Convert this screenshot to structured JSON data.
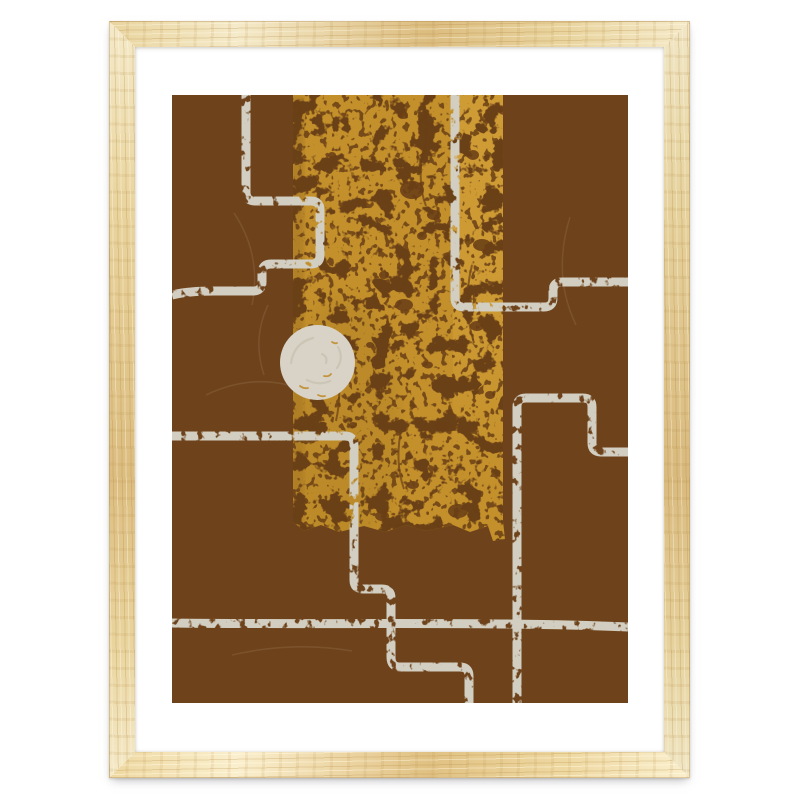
{
  "title": "Framed abstract art print",
  "colors": {
    "page_background": "#ffffff",
    "frame_wood_base": "#e9d49e",
    "frame_wood_light": "#f5eac9",
    "frame_wood_dark": "#dcbd80",
    "mat": "#ffffff",
    "art_brown": "#6e421a",
    "band_mustard": "#c3902b",
    "band_mustard_light": "#cf9c35",
    "speckle_brown": "#6a3f16",
    "line_cream": "#d2cec1",
    "circle_cream": "#d8d3c6",
    "swirl": "#c7c1b0",
    "fleck_mustard": "#c08a28"
  },
  "artwork": {
    "style": "abstract-geometric-print",
    "elements": [
      "brown-field",
      "distressed-mustard-band",
      "stepped-cream-lines",
      "cream-circle"
    ]
  }
}
